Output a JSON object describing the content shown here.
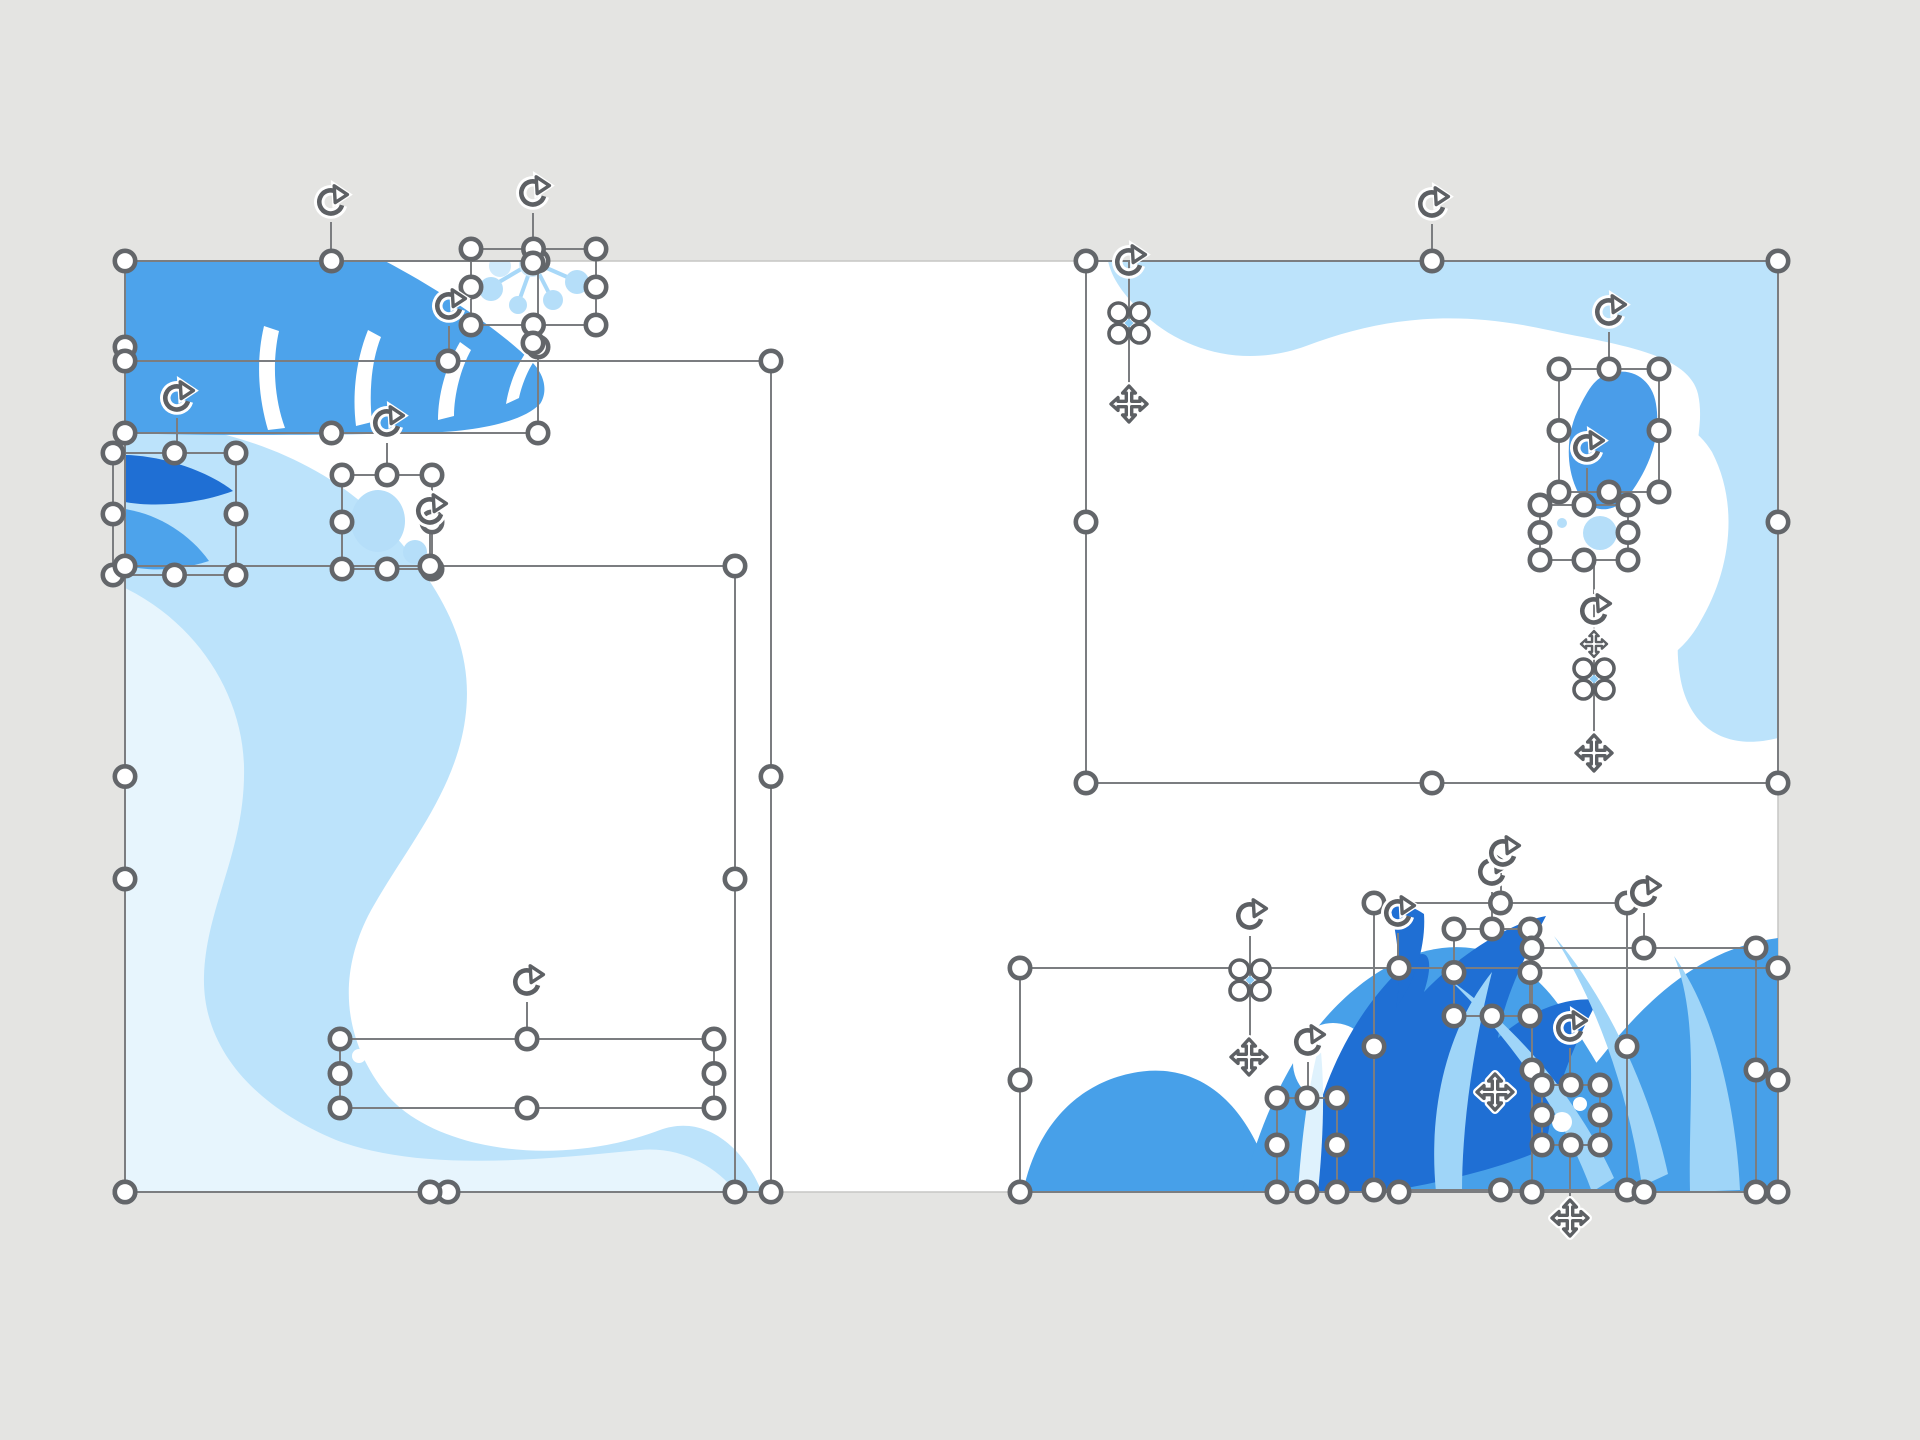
{
  "app": {
    "workspace_background": "#e4e4e2",
    "slide": {
      "x": 125,
      "y": 261,
      "width": 1653,
      "height": 931,
      "fill": "#ffffff",
      "edge_color": "#c6c6c4"
    }
  },
  "palette": {
    "blue_medium": "#4da3eb",
    "blue_dark": "#1f6fd4",
    "blue_deep_accent": "#4a9de9",
    "blue_light": "#bce3fb",
    "blue_lighter": "#e7f5fd",
    "blue_pale_circle": "#b5def9",
    "blue_blade": "#9fd5f8",
    "blue_sliver": "#dff2fd",
    "ui_stroke": "#5d6064",
    "handle_stroke": "#63666a",
    "line_color": "#7b7d80"
  },
  "selection_ui": {
    "boxes": [
      {
        "id": "leaf-top-left",
        "x": 125,
        "y": 261,
        "w": 413,
        "h": 172
      },
      {
        "id": "dandelion",
        "x": 471,
        "y": 249,
        "w": 125,
        "h": 76
      },
      {
        "id": "wave-left-light",
        "x": 125,
        "y": 361,
        "w": 646,
        "h": 831
      },
      {
        "id": "petals-left",
        "x": 113,
        "y": 453,
        "w": 123,
        "h": 122
      },
      {
        "id": "bubbles-mid-left",
        "x": 342,
        "y": 475,
        "w": 90,
        "h": 94
      },
      {
        "id": "wave-left-lighter",
        "x": 125,
        "y": 566,
        "w": 610,
        "h": 626
      },
      {
        "id": "dots-bottom-left",
        "x": 340,
        "y": 1039,
        "w": 374,
        "h": 69
      },
      {
        "id": "band-top-right",
        "x": 1086,
        "y": 261,
        "w": 692,
        "h": 522
      },
      {
        "id": "blob-top-right",
        "x": 1559,
        "y": 369,
        "w": 100,
        "h": 123
      },
      {
        "id": "bubbles-top-right",
        "x": 1540,
        "y": 505,
        "w": 88,
        "h": 55
      },
      {
        "id": "wave-bottom-right",
        "x": 1020,
        "y": 968,
        "w": 758,
        "h": 224
      },
      {
        "id": "dark-leaf-bottom",
        "x": 1374,
        "y": 903,
        "w": 253,
        "h": 287
      },
      {
        "id": "bubbles-bottom-1",
        "x": 1454,
        "y": 929,
        "w": 76,
        "h": 87
      },
      {
        "id": "leafgroup-bottom",
        "x": 1532,
        "y": 948,
        "w": 224,
        "h": 244
      },
      {
        "id": "dots-bottom-right",
        "x": 1542,
        "y": 1085,
        "w": 58,
        "h": 60
      },
      {
        "id": "sliver-bottom",
        "x": 1277,
        "y": 1098,
        "w": 60,
        "h": 94
      }
    ],
    "rotate_handles": [
      {
        "x": 331,
        "y": 202
      },
      {
        "x": 533,
        "y": 193
      },
      {
        "x": 449,
        "y": 306
      },
      {
        "x": 177,
        "y": 398
      },
      {
        "x": 387,
        "y": 423
      },
      {
        "x": 430,
        "y": 511
      },
      {
        "x": 1432,
        "y": 204
      },
      {
        "x": 1129,
        "y": 262
      },
      {
        "x": 1609,
        "y": 312
      },
      {
        "x": 1587,
        "y": 448
      },
      {
        "x": 1594,
        "y": 611
      },
      {
        "x": 527,
        "y": 982
      },
      {
        "x": 1250,
        "y": 916
      },
      {
        "x": 1398,
        "y": 913
      },
      {
        "x": 1492,
        "y": 872
      },
      {
        "x": 1503,
        "y": 853
      },
      {
        "x": 1644,
        "y": 893
      },
      {
        "x": 1570,
        "y": 1028
      },
      {
        "x": 1308,
        "y": 1042
      }
    ],
    "move_handles": [
      {
        "x": 1129,
        "y": 404,
        "s": 1
      },
      {
        "x": 1594,
        "y": 753,
        "s": 1
      },
      {
        "x": 1594,
        "y": 644,
        "s": 0.72
      },
      {
        "x": 1249,
        "y": 1057,
        "s": 1
      },
      {
        "x": 1495,
        "y": 1092,
        "s": 1
      },
      {
        "x": 1570,
        "y": 1218,
        "s": 1
      }
    ],
    "floret_handles": [
      {
        "x": 1129,
        "y": 323
      },
      {
        "x": 1594,
        "y": 679
      },
      {
        "x": 1250,
        "y": 980
      }
    ],
    "connectors": [
      [
        331,
        222,
        331,
        261
      ],
      [
        533,
        213,
        533,
        249
      ],
      [
        449,
        326,
        449,
        361
      ],
      [
        177,
        418,
        177,
        453
      ],
      [
        387,
        443,
        387,
        475
      ],
      [
        430,
        531,
        430,
        566
      ],
      [
        1432,
        224,
        1432,
        261
      ],
      [
        1609,
        332,
        1609,
        369
      ],
      [
        1587,
        468,
        1587,
        505
      ],
      [
        527,
        1002,
        527,
        1039
      ],
      [
        1398,
        933,
        1398,
        968
      ],
      [
        1492,
        892,
        1492,
        929
      ],
      [
        1501,
        873,
        1501,
        903
      ],
      [
        1644,
        913,
        1644,
        948
      ],
      [
        1570,
        1048,
        1570,
        1085
      ],
      [
        1308,
        1062,
        1308,
        1098
      ],
      [
        1129,
        262,
        1129,
        404
      ],
      [
        1594,
        560,
        1594,
        753
      ],
      [
        1250,
        936,
        1250,
        1048
      ],
      [
        1570,
        1145,
        1570,
        1212
      ]
    ],
    "extra_handles": [
      [
        533,
        263
      ],
      [
        533,
        343
      ]
    ]
  }
}
